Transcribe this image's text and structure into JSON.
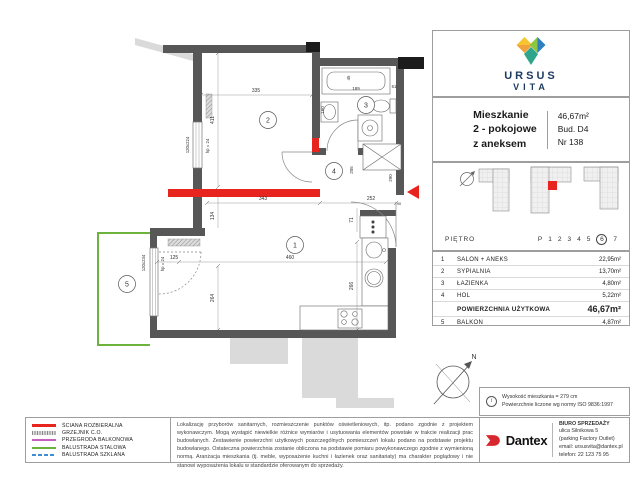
{
  "brand": {
    "name_line1": "URSUS",
    "name_line2": "VITA"
  },
  "apartment": {
    "title_line1": "Mieszkanie",
    "title_line2": "2 - pokojowe",
    "title_line3": "z aneksem",
    "area": "46,67m²",
    "building": "Bud. D4",
    "number": "Nr 138"
  },
  "site_plan": {
    "floor_label": "PIĘTRO",
    "floors": [
      "P",
      "1",
      "2",
      "3",
      "4",
      "5",
      "6",
      "7"
    ],
    "active_floor": "6",
    "unit_color": "#e8241f"
  },
  "room_table": {
    "rows": [
      {
        "no": "1",
        "name": "SALON + ANEKS",
        "area": "22,95m²"
      },
      {
        "no": "2",
        "name": "SYPIALNIA",
        "area": "13,70m²"
      },
      {
        "no": "3",
        "name": "ŁAZIENKA",
        "area": "4,80m²"
      },
      {
        "no": "4",
        "name": "HOL",
        "area": "5,22m²"
      }
    ],
    "total_label": "POWIERZCHNIA UŻYTKOWA",
    "total_area": "46,67m²",
    "balcony_row": {
      "no": "5",
      "name": "BALKON",
      "area": "4,87m²"
    }
  },
  "note": {
    "line1": "Wysokość mieszkania = 279 cm",
    "line2": "Powierzchnie liczone wg normy ISO 9836:1997"
  },
  "legend": {
    "items": [
      {
        "label": "ŚCIANA ROZBIERALNA",
        "color": "#e8241f"
      },
      {
        "label": "GRZEJNIK C.O.",
        "color": "#8a8a8a"
      },
      {
        "label": "PRZEGRODA BALKONOWA",
        "color": "#c75fc0"
      },
      {
        "label": "BALUSTRADA STALOWA",
        "color": "#6cb33e"
      },
      {
        "label": "BALUSTRADA SZKLANA",
        "color": "#3f8fd2"
      }
    ]
  },
  "disclaimer": "Lokalizację przyborów sanitarnych, rozmieszczenie punktów oświetleniowych, itp. podano zgodnie z projektem wykonawczym. Mogą wystąpić niewielkie różnice wymiarów i usytuowania elementów powstałe w trakcie realizacji prac budowlanych. Zestawienie powierzchni użytkowych poszczególnych pomieszczeń lokalu podano na podstawie projektu budowlanego. Ostateczna powierzchnia zostanie obliczona na podstawie pomiaru powykonawczego zgodnie z wymienioną normą. Aranżacja mieszkania (tj. meble, wyposażenie kuchni i łazienek oraz sanitariaty) ma charakter poglądowy i nie stanowi wyposażenia lokalu w standardzie oferowanym do sprzedaży.",
  "dealer": {
    "logo_text": "Dantex",
    "office_line0": "BIURO SPRZEDAŻY",
    "office_line1": "ulica Silnikowa 5",
    "office_line2": "(parking Factory Outlet)",
    "office_line3": "email: ursusvita@dantex.pl",
    "office_line4": "telefon: 22 123 75 95"
  },
  "plan": {
    "room_numbers": [
      "1",
      "2",
      "3",
      "4",
      "5"
    ],
    "dims": {
      "bedroom_w": "335",
      "bedroom_h": "411",
      "salon_top": "343",
      "entry_w": "252",
      "d134": "134",
      "salon_w": "460",
      "d264": "264",
      "balcony_door_w": "125",
      "nook_w": "71",
      "kitchen_h": "266",
      "hall_h": "290",
      "hall_w": "205",
      "bath_w": "160",
      "tub_l": "189",
      "tub_w": "45",
      "d61": "61",
      "door_w": "90"
    },
    "windows": {
      "bedroom": "120x224",
      "balcony": "120x234",
      "parapet": "hp = 24"
    },
    "compass": "N",
    "wall_color": "#575757",
    "removable_wall_color": "#e8241f",
    "balcony_rail_color": "#6cb33e"
  }
}
